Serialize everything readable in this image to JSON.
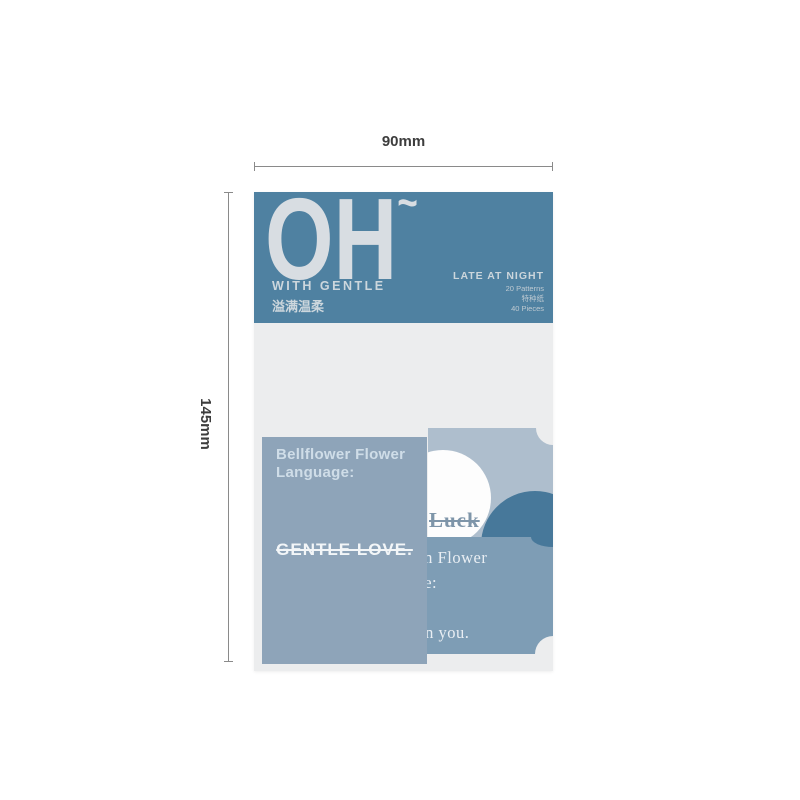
{
  "annotations": {
    "width_label": "90mm",
    "height_label": "145mm"
  },
  "package": {
    "header": {
      "title": "OH",
      "title_tilde": "~",
      "subtitle_en": "WITH GENTLE",
      "subtitle_cn": "溢满温柔",
      "right": {
        "line1": "LATE AT NIGHT",
        "line2": "20 Patterns",
        "line3": "特种纸",
        "line4": "40 Pieces"
      }
    },
    "cards": {
      "front_card": {
        "line1": "Bellflower Flower",
        "line2": "Language:",
        "message": "GENTLE LOVE."
      },
      "top_right_card": {
        "word": "Luck"
      },
      "bottom_right_card": {
        "line1": "Geranium Flower",
        "line2": "Language:",
        "line3": "in you."
      }
    }
  },
  "colors": {
    "header_blue": "#4f81a1",
    "backing": "#ecedee",
    "front_card": "#8ea4b9",
    "top_right_card": "#aebecd",
    "bottom_right_card": "#7e9db5",
    "teal_accent": "#47789a",
    "dimension_text": "#3d3d3d"
  }
}
